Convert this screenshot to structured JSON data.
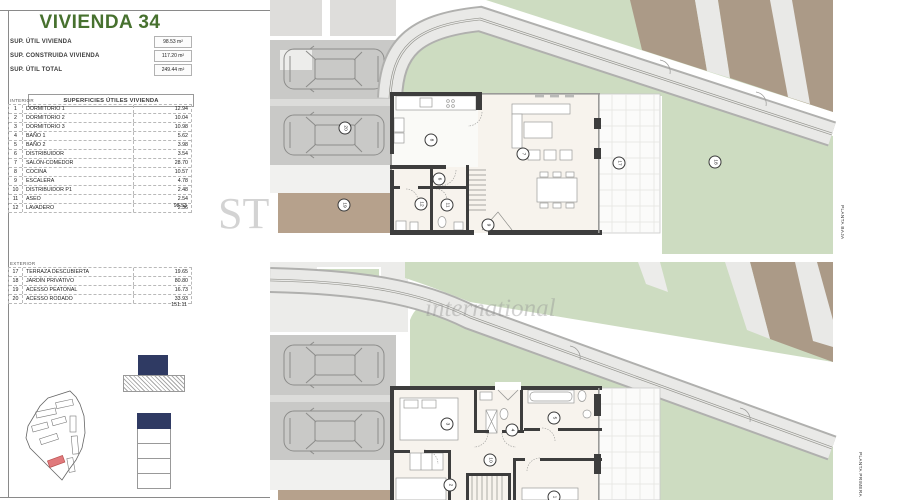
{
  "sheet": {
    "title": "VIVIENDA 34",
    "summary": [
      {
        "label": "SUP. ÚTIL VIVIENDA",
        "value": "98.53 m²"
      },
      {
        "label": "SUP. CONSTRUIDA VIVIENDA",
        "value": "117.20 m²"
      },
      {
        "label": "SUP. ÚTIL TOTAL",
        "value": "249.44 m²"
      }
    ],
    "table_title": "SUPERFICIES ÚTILES VIVIENDA",
    "interior": {
      "label": "INTERIOR",
      "rows": [
        [
          "1",
          "DORMITORIO 1",
          "12.94"
        ],
        [
          "2",
          "DORMITORIO 2",
          "10.04"
        ],
        [
          "3",
          "DORMITORIO 3",
          "10.98"
        ],
        [
          "4",
          "BAÑO 1",
          "5.62"
        ],
        [
          "5",
          "BAÑO 2",
          "3.98"
        ],
        [
          "6",
          "DISTRIBUIDOR",
          "3.54"
        ],
        [
          "7",
          "SALÓN-COMEDOR",
          "28.70"
        ],
        [
          "8",
          "COCINA",
          "10.57"
        ],
        [
          "9",
          "ESCALERA",
          "4.78"
        ],
        [
          "10",
          "DISTRIBUIDOR P1",
          "2.48"
        ],
        [
          "11",
          "ASEO",
          "2.54"
        ],
        [
          "12",
          "LAVADERO",
          "2.36"
        ]
      ],
      "total": "98.53"
    },
    "exterior": {
      "label": "EXTERIOR",
      "rows": [
        [
          "17",
          "TERRAZA DESCUBIERTA",
          "19.65"
        ],
        [
          "18",
          "JARDÍN PRIVATIVO",
          "80.80"
        ],
        [
          "19",
          "ACESSO PEATONAL",
          "16.73"
        ],
        [
          "20",
          "ACESSO RODADO",
          "33.93"
        ]
      ],
      "total": "151.11"
    },
    "plans": [
      {
        "name": "PLANTA BAJA",
        "markers": [
          {
            "n": "8",
            "x": 161,
            "y": 140
          },
          {
            "n": "7",
            "x": 253,
            "y": 154
          },
          {
            "n": "6",
            "x": 169,
            "y": 179
          },
          {
            "n": "9",
            "x": 218,
            "y": 225
          },
          {
            "n": "11",
            "x": 177,
            "y": 205
          },
          {
            "n": "12",
            "x": 151,
            "y": 204
          },
          {
            "n": "17",
            "x": 349,
            "y": 163
          },
          {
            "n": "18",
            "x": 445,
            "y": 162
          },
          {
            "n": "19",
            "x": 74,
            "y": 205
          },
          {
            "n": "20",
            "x": 75,
            "y": 128
          }
        ]
      },
      {
        "name": "PLANTA PRIMERA",
        "markers": [
          {
            "n": "3",
            "x": 177,
            "y": 162
          },
          {
            "n": "4",
            "x": 242,
            "y": 168
          },
          {
            "n": "5",
            "x": 284,
            "y": 156
          },
          {
            "n": "10",
            "x": 220,
            "y": 198
          },
          {
            "n": "2",
            "x": 180,
            "y": 223
          },
          {
            "n": "1",
            "x": 284,
            "y": 235
          }
        ]
      }
    ],
    "watermark": {
      "left": "ST",
      "right": "international"
    },
    "colors": {
      "title_green": "#47712f",
      "legend_navy": "#2f3a63",
      "highlight_red": "#e0797c",
      "garden_green": "#cddcc1",
      "tan": "#b6a18c"
    }
  }
}
